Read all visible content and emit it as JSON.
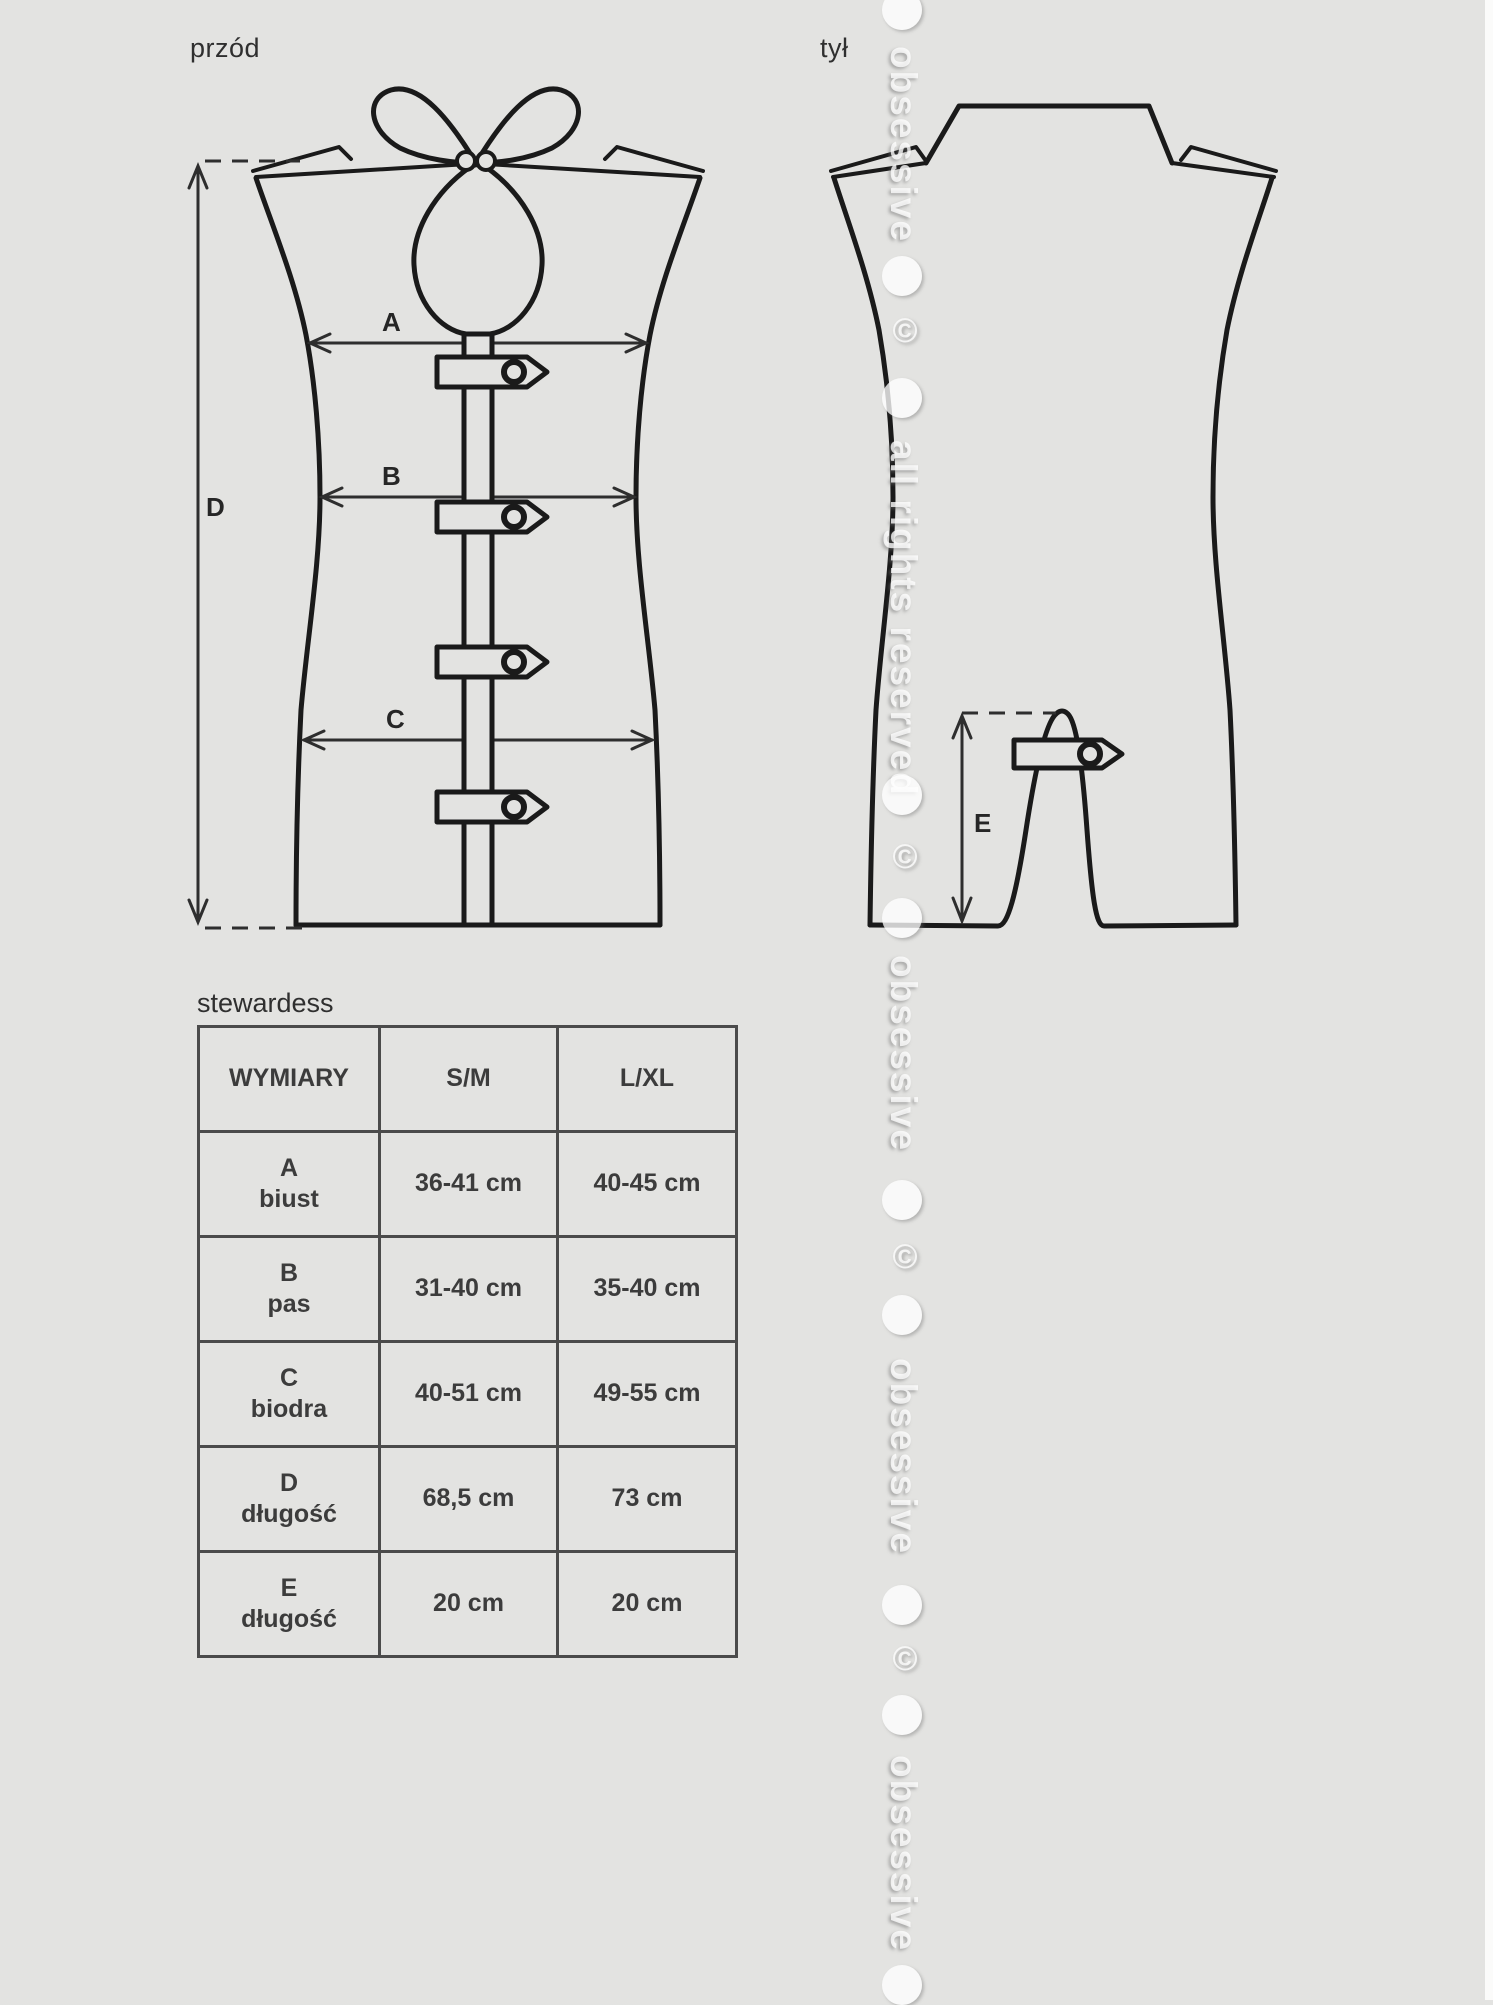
{
  "theme": {
    "bg": "#e3e3e1",
    "line": "#1a1a1a",
    "dim": "#2e2e2e",
    "tableBorder": "#4b4b4b",
    "text": "#3c3c3c"
  },
  "views": {
    "front_label": "przód",
    "back_label": "tył"
  },
  "dimensions": {
    "A": "A",
    "B": "B",
    "C": "C",
    "D": "D",
    "E": "E"
  },
  "product": {
    "name": "stewardess"
  },
  "size_table": {
    "headers": [
      "WYMIARY",
      "S/M",
      "L/XL"
    ],
    "rows": [
      {
        "letter": "A",
        "name": "biust",
        "sm": "36-41 cm",
        "lxl": "40-45 cm"
      },
      {
        "letter": "B",
        "name": "pas",
        "sm": "31-40 cm",
        "lxl": "35-40 cm"
      },
      {
        "letter": "C",
        "name": "biodra",
        "sm": "40-51 cm",
        "lxl": "49-55 cm"
      },
      {
        "letter": "D",
        "name": "długość",
        "sm": "68,5 cm",
        "lxl": "73 cm"
      },
      {
        "letter": "E",
        "name": "długość",
        "sm": "20 cm",
        "lxl": "20 cm"
      }
    ]
  },
  "watermark": {
    "items": [
      {
        "type": "circle",
        "y": -10
      },
      {
        "type": "text",
        "y": 46,
        "text": "obsessive"
      },
      {
        "type": "circle",
        "y": 256
      },
      {
        "type": "copyright",
        "y": 312,
        "text": "©"
      },
      {
        "type": "circle",
        "y": 378
      },
      {
        "type": "text",
        "y": 440,
        "text": "all rights reserved"
      },
      {
        "type": "circle",
        "y": 775
      },
      {
        "type": "copyright",
        "y": 838,
        "text": "©"
      },
      {
        "type": "circle",
        "y": 898
      },
      {
        "type": "text",
        "y": 955,
        "text": "obsessive"
      },
      {
        "type": "circle",
        "y": 1180
      },
      {
        "type": "copyright",
        "y": 1238,
        "text": "©"
      },
      {
        "type": "circle",
        "y": 1295
      },
      {
        "type": "text",
        "y": 1358,
        "text": "obsessive"
      },
      {
        "type": "circle",
        "y": 1585
      },
      {
        "type": "copyright",
        "y": 1640,
        "text": "©"
      },
      {
        "type": "circle",
        "y": 1695
      },
      {
        "type": "text",
        "y": 1755,
        "text": "obsessive"
      },
      {
        "type": "circle",
        "y": 1965
      }
    ]
  }
}
